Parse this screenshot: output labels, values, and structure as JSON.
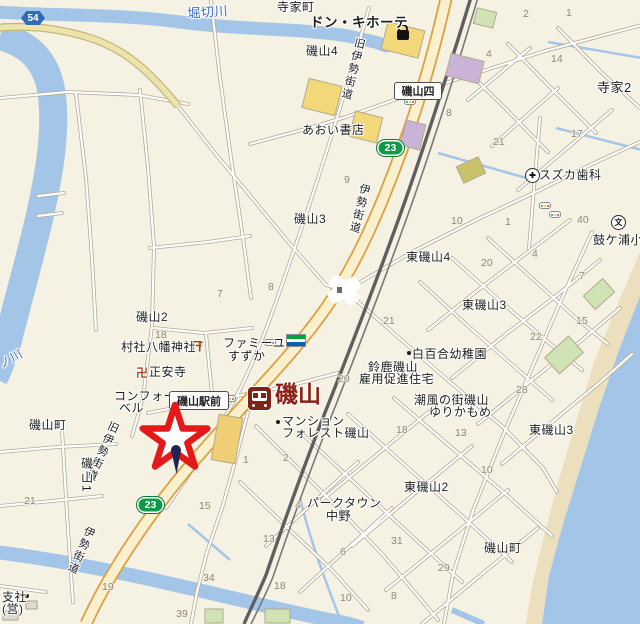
{
  "map": {
    "colors": {
      "background": "#f6f2e3",
      "water": "#a3c6e8",
      "beach": "#ebdfbe",
      "route23_green": "#0f9a48",
      "pref_blue": "#2f6cb3",
      "station_maroon": "#7d2418",
      "star_red": "#e41a1a"
    },
    "station": {
      "label": "磯山"
    },
    "labels": [
      {
        "t": "寺家町",
        "x": 277,
        "y": 1
      },
      {
        "t": "ドン・キホーテ",
        "x": 310,
        "y": 16,
        "s": 13.5,
        "b": 1
      },
      {
        "t": "磯山4",
        "x": 306,
        "y": 45
      },
      {
        "t": "寺家2",
        "x": 597,
        "y": 81,
        "s": 13
      },
      {
        "t": "あおい書店",
        "x": 302,
        "y": 124
      },
      {
        "t": "磯山3",
        "x": 294,
        "y": 213
      },
      {
        "t": "スズカ歯科",
        "x": 539,
        "y": 169
      },
      {
        "t": "鼓ケ浦小",
        "x": 593,
        "y": 234
      },
      {
        "t": "東磯山4",
        "x": 406,
        "y": 251
      },
      {
        "t": "東磯山3",
        "x": 462,
        "y": 299
      },
      {
        "t": "東磯山3",
        "x": 529,
        "y": 424
      },
      {
        "t": "東磯山2",
        "x": 404,
        "y": 481
      },
      {
        "t": "磯山2",
        "x": 136,
        "y": 311
      },
      {
        "t": "磯山町",
        "x": 29,
        "y": 419
      },
      {
        "t": "磯山町",
        "x": 484,
        "y": 542
      },
      {
        "t": "村社八幡神社",
        "x": 121,
        "y": 341
      },
      {
        "t": "正安寺",
        "x": 149,
        "y": 366
      },
      {
        "t": "ファミーユ",
        "x": 223,
        "y": 337
      },
      {
        "t": "すずか",
        "x": 228,
        "y": 350
      },
      {
        "t": "コンフォート",
        "x": 114,
        "y": 390
      },
      {
        "t": "ベル",
        "x": 119,
        "y": 402
      },
      {
        "t": "マンション",
        "x": 282,
        "y": 415
      },
      {
        "t": "フォレスト磯山",
        "x": 282,
        "y": 427
      },
      {
        "t": "鈴鹿磯山",
        "x": 368,
        "y": 361
      },
      {
        "t": "雇用促進住宅",
        "x": 359,
        "y": 373
      },
      {
        "t": "白百合幼稚園",
        "x": 412,
        "y": 348
      },
      {
        "t": "潮風の街磯山",
        "x": 414,
        "y": 394
      },
      {
        "t": "ゆりかもめ",
        "x": 429,
        "y": 406
      },
      {
        "t": "パークタウン",
        "x": 307,
        "y": 497
      },
      {
        "t": "中野",
        "x": 326,
        "y": 510
      },
      {
        "t": "支社",
        "x": 2,
        "y": 591
      },
      {
        "t": "(営)",
        "x": 2,
        "y": 603
      },
      {
        "t": "堀切川",
        "x": 187,
        "y": 7,
        "c": "#3a6cc0",
        "s": 13,
        "r": -4
      },
      {
        "t": "ノ川",
        "x": -3,
        "y": 360,
        "c": "#3a6cc0",
        "r": -30
      },
      {
        "t": "旧伊勢街道",
        "x": 354,
        "y": 36,
        "v": 1,
        "r": 14,
        "s": 11
      },
      {
        "t": "伊勢街道",
        "x": 359,
        "y": 182,
        "v": 1,
        "r": 14,
        "s": 11
      },
      {
        "t": "旧伊勢街道",
        "x": 109,
        "y": 419,
        "v": 1,
        "r": 24,
        "s": 11
      },
      {
        "t": "伊勢街道",
        "x": 85,
        "y": 524,
        "v": 1,
        "r": 24,
        "s": 11
      },
      {
        "t": "磯山1",
        "x": 80,
        "y": 457,
        "v": 1,
        "s": 12
      }
    ],
    "numbers": [
      {
        "t": "2",
        "x": 523,
        "y": 9
      },
      {
        "t": "1",
        "x": 566,
        "y": 8
      },
      {
        "t": "4",
        "x": 486,
        "y": 49
      },
      {
        "t": "14",
        "x": 551,
        "y": 54
      },
      {
        "t": "8",
        "x": 446,
        "y": 108
      },
      {
        "t": "21",
        "x": 493,
        "y": 137
      },
      {
        "t": "17",
        "x": 571,
        "y": 129
      },
      {
        "t": "9",
        "x": 344,
        "y": 175
      },
      {
        "t": "10",
        "x": 451,
        "y": 216
      },
      {
        "t": "1",
        "x": 505,
        "y": 217
      },
      {
        "t": "40",
        "x": 577,
        "y": 215
      },
      {
        "t": "4",
        "x": 532,
        "y": 249
      },
      {
        "t": "20",
        "x": 481,
        "y": 258
      },
      {
        "t": "7",
        "x": 579,
        "y": 271
      },
      {
        "t": "8",
        "x": 268,
        "y": 282
      },
      {
        "t": "7",
        "x": 217,
        "y": 289
      },
      {
        "t": "18",
        "x": 155,
        "y": 330
      },
      {
        "t": "21",
        "x": 383,
        "y": 316
      },
      {
        "t": "15",
        "x": 576,
        "y": 316
      },
      {
        "t": "22",
        "x": 530,
        "y": 332
      },
      {
        "t": "28",
        "x": 516,
        "y": 385
      },
      {
        "t": "20",
        "x": 338,
        "y": 374
      },
      {
        "t": "13",
        "x": 455,
        "y": 428
      },
      {
        "t": "18",
        "x": 396,
        "y": 425
      },
      {
        "t": "1",
        "x": 243,
        "y": 455
      },
      {
        "t": "2",
        "x": 283,
        "y": 453
      },
      {
        "t": "4",
        "x": 295,
        "y": 500
      },
      {
        "t": "21",
        "x": 24,
        "y": 496
      },
      {
        "t": "15",
        "x": 199,
        "y": 501
      },
      {
        "t": "19",
        "x": 102,
        "y": 582
      },
      {
        "t": "13",
        "x": 263,
        "y": 534
      },
      {
        "t": "34",
        "x": 203,
        "y": 573
      },
      {
        "t": "6",
        "x": 340,
        "y": 547
      },
      {
        "t": "31",
        "x": 391,
        "y": 536
      },
      {
        "t": "29",
        "x": 438,
        "y": 563
      },
      {
        "t": "10",
        "x": 481,
        "y": 465
      },
      {
        "t": "10",
        "x": 340,
        "y": 593
      },
      {
        "t": "8",
        "x": 391,
        "y": 591
      },
      {
        "t": "18",
        "x": 274,
        "y": 581
      },
      {
        "t": "39",
        "x": 176,
        "y": 609
      }
    ],
    "nameboxes": [
      {
        "t": "磯山四",
        "x": 394,
        "y": 82,
        "w": 46,
        "h": 16
      },
      {
        "t": "磯山駅前",
        "x": 169,
        "y": 391,
        "w": 58,
        "h": 17
      }
    ],
    "shields": [
      {
        "num": "23",
        "x": 377,
        "y": 140,
        "pref": 0
      },
      {
        "num": "23",
        "x": 137,
        "y": 497,
        "pref": 0
      },
      {
        "num": "54",
        "x": 21,
        "y": 11,
        "pref": 1
      }
    ],
    "icons": [
      {
        "k": "hospital",
        "x": 525,
        "y": 168
      },
      {
        "k": "school",
        "x": 611,
        "y": 215,
        "glyph": "文"
      },
      {
        "k": "torii",
        "x": 190,
        "y": 341
      },
      {
        "k": "manji",
        "x": 136,
        "y": 364,
        "glyph": "卍"
      },
      {
        "k": "famima",
        "x": 286,
        "y": 334
      },
      {
        "k": "signal",
        "x": 264,
        "y": 339
      },
      {
        "k": "signal",
        "x": 224,
        "y": 395
      },
      {
        "k": "signal",
        "x": 539,
        "y": 202
      },
      {
        "k": "signal",
        "x": 549,
        "y": 211
      },
      {
        "k": "signal",
        "x": 404,
        "y": 98
      },
      {
        "k": "dot",
        "x": 359,
        "y": 129
      },
      {
        "k": "dot",
        "x": 276,
        "y": 420
      },
      {
        "k": "dot",
        "x": 407,
        "y": 351
      },
      {
        "k": "dot",
        "x": 25,
        "y": 594
      },
      {
        "k": "bag",
        "x": 395,
        "y": 25
      }
    ]
  }
}
